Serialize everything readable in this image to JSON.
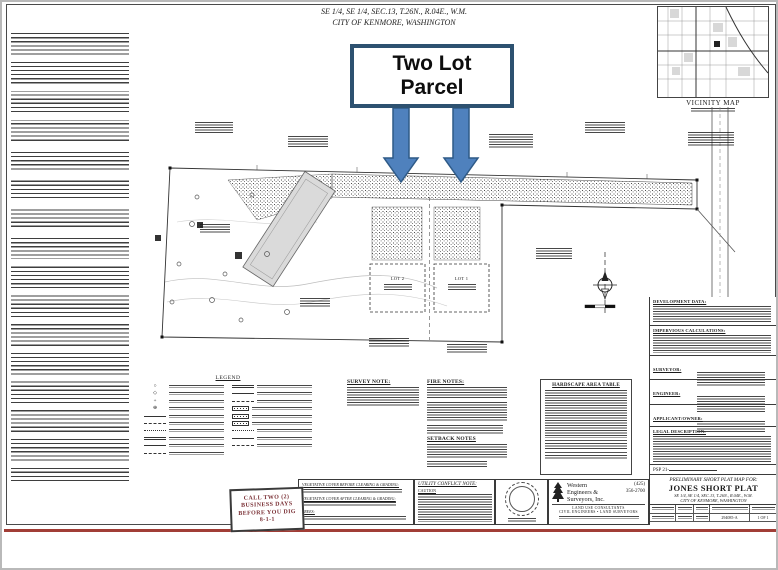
{
  "slide": {
    "accent_line_color": "#a13d36",
    "border_color": "#b9b9b9"
  },
  "sheet": {
    "header_line1": "SE 1/4, SE 1/4, SEC.13, T.26N., R.04E., W.M.",
    "header_line2": "CITY OF KENMORE, WASHINGTON"
  },
  "callout": {
    "line1": "Two Lot",
    "line2": "Parcel",
    "border_color": "#2d5170",
    "arrow_fill": "#4f81bd",
    "arrow_stroke": "#2e5a87"
  },
  "vicinity": {
    "caption": "VICINITY MAP"
  },
  "plan": {
    "lot1_label": "LOT 1",
    "lot2_label": "LOT 2"
  },
  "legend": {
    "title": "LEGEND"
  },
  "notes": {
    "survey_title": "SURVEY NOTE:",
    "fire_title": "FIRE NOTES:",
    "setback_title": "SETBACK NOTES",
    "hardscape_title": "HARDSCAPE AREA TABLE"
  },
  "dig_stamp": {
    "line1": "CALL TWO (2)",
    "line2": "BUSINESS DAYS",
    "line3": "BEFORE YOU DIG",
    "line4": "8-1-1",
    "color": "#7b3136"
  },
  "veg_box": {
    "before_title": "VEGETATIVE COVER BEFORE CLEARING & GRADING:",
    "after_title": "VEGETATIVE COVER AFTER CLEARING & GRADING:",
    "trees_title": "TREES:"
  },
  "utility": {
    "title": "UTILITY CONFLICT NOTE:",
    "caution": "CAUTION"
  },
  "company": {
    "name_line1": "Western",
    "name_line2": "Engineers &",
    "name_line3": "Surveyors, Inc.",
    "phone_area": "(425)",
    "phone": "356-2700",
    "tagline1": "LAND USE CONSULTANTS",
    "tagline2": "CIVIL ENGINEERS  •  LAND SURVEYORS"
  },
  "titleblock": {
    "psp": "PSP 21-",
    "for_line": "PRELIMINARY SHORT PLAT MAP FOR:",
    "title": "JONES SHORT PLAT",
    "sec_line": "SE 1/4, SE 1/4, SEC.13, T.26N., R.04E., W.M.",
    "city_line": "CITY OF KENMORE, WASHINGTON",
    "job_no": "294085-A",
    "sheet_no": "1 OF 1"
  },
  "panel": {
    "s1": "DEVELOPMENT DATA:",
    "s2": "IMPERVIOUS CALCULATIONS:",
    "s3": "SURVEYOR:",
    "s4": "ENGINEER:",
    "s5": "APPLICANT/OWNER:",
    "s6": "LEGAL DESCRIPTION:"
  }
}
